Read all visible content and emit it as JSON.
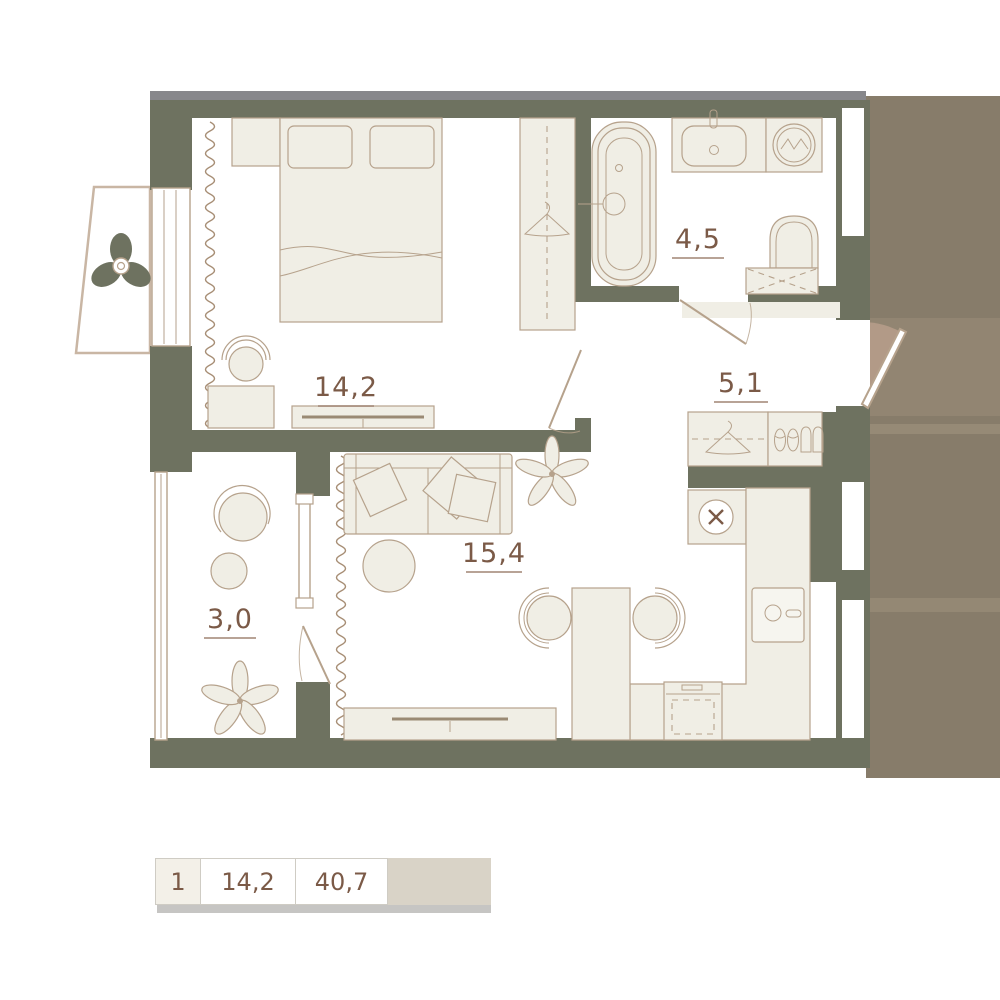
{
  "plan": {
    "rooms": [
      {
        "name": "bedroom",
        "area": "14,2"
      },
      {
        "name": "bathroom",
        "area": "4,5"
      },
      {
        "name": "hallway",
        "area": "5,1"
      },
      {
        "name": "living-room-kitchen",
        "area": "15,4"
      },
      {
        "name": "balcony",
        "area": "3,0"
      }
    ]
  },
  "legend": {
    "rooms_count": "1",
    "living_area": "14,2",
    "total_area": "40,7"
  },
  "colors": {
    "wall": "#6e7260",
    "furniture": "#f0eee5",
    "furniture-line": "#b6a28c",
    "accent": "#7b5a47",
    "corridor": "#877c6a",
    "corridor-light": "#b29a87",
    "corridor-band": "#9a8d79",
    "top-bar": "#87878b",
    "legend-cell": "#f3f0e8",
    "legend-tail": "#d9d3c7",
    "legend-shadow": "#c6c5c3",
    "legend-border": "#cfccc4"
  }
}
